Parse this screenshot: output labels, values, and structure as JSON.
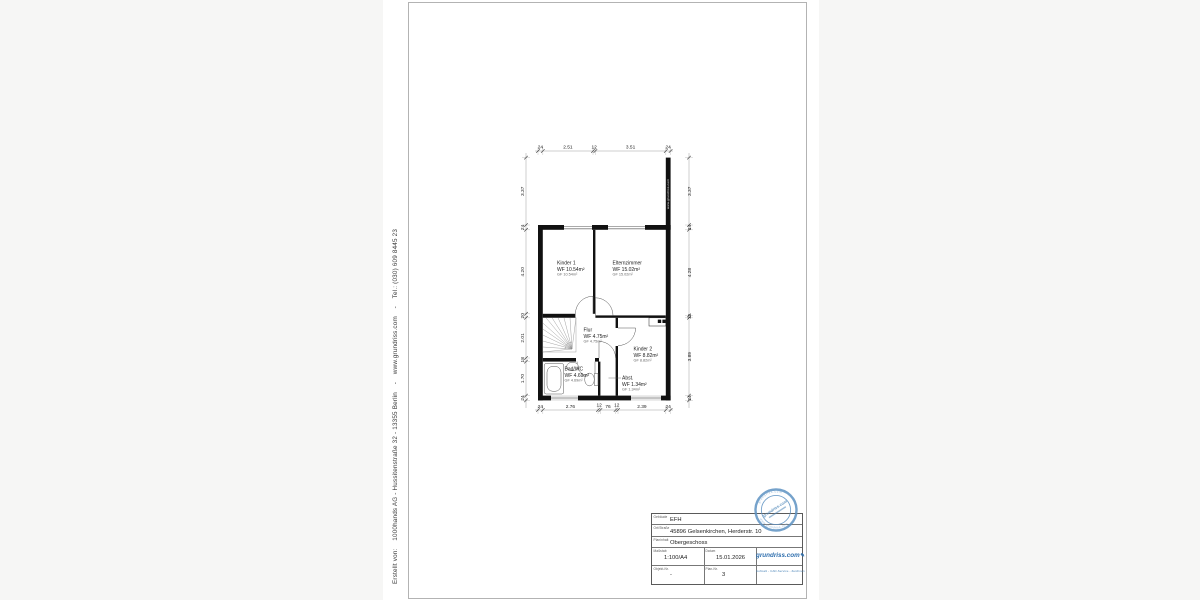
{
  "colors": {
    "accent_blue": "#2f6fae",
    "stamp_blue": "#5e92c2",
    "wall_black": "#111111"
  },
  "margin_note": "Erstellt von:    1000hands AG - Hussitenstraße 32 - 13355 Berlin    -    www.grundriss.com    -    Tel.: (030) 609 8445 23",
  "plan": {
    "wall_watermark": "www.grundriss.com",
    "rooms": [
      {
        "name": "Kinder 1",
        "wf": "WF 10.54m²",
        "gf": "GF 10.54m²"
      },
      {
        "name": "Elternzimmer",
        "wf": "WF 15.02m²",
        "gf": "GF 15.02m²"
      },
      {
        "name": "Flur",
        "wf": "WF 4.75m²",
        "gf": "GF 4.75m²"
      },
      {
        "name": "Kinder 2",
        "wf": "WF 8.82m²",
        "gf": "GF 8.82m²"
      },
      {
        "name": "Bad/WC",
        "wf": "WF 4.69m²",
        "gf": "GF 4.69m²"
      },
      {
        "name": "Abst.",
        "wf": "WF 1.34m²",
        "gf": "GF 1.34m²"
      }
    ],
    "dims": {
      "top": [
        "24",
        "2.51",
        "12",
        "3.51",
        "24"
      ],
      "bottom": [
        "24",
        "2.76",
        "12",
        "76",
        "12",
        "2.39",
        "24"
      ],
      "left": [
        "3.37",
        "24",
        "4.20",
        "20",
        "2.01",
        "18",
        "1.70",
        "24"
      ],
      "right": [
        "3.37",
        "24",
        "4.28",
        "12",
        "3.89",
        "24"
      ]
    }
  },
  "title_block": {
    "rows": [
      {
        "label": "Gebäude",
        "value": "EFH"
      },
      {
        "label": "Ort/Straße",
        "value": "45896 Gelsenkirchen, Herderstr. 10"
      },
      {
        "label": "Planinhalt",
        "value": "Obergeschoss"
      },
      {
        "label": "Maßstab",
        "value": "1:100/A4"
      },
      {
        "label": "Datum",
        "value": "15.01.2026"
      },
      {
        "label": "Objekt-Nr.",
        "value": "-"
      },
      {
        "label": "Plan-Nr.",
        "value": "3"
      }
    ],
    "logo": {
      "text": "grundriss.com",
      "pen": "✎",
      "tagline": "Aufmaß - CAD-Service - Zeichnen"
    }
  },
  "stamp": {
    "rim_top": "grundriss.com",
    "rim_bottom": "www.grundriss.com",
    "center": "grundriss.com"
  }
}
